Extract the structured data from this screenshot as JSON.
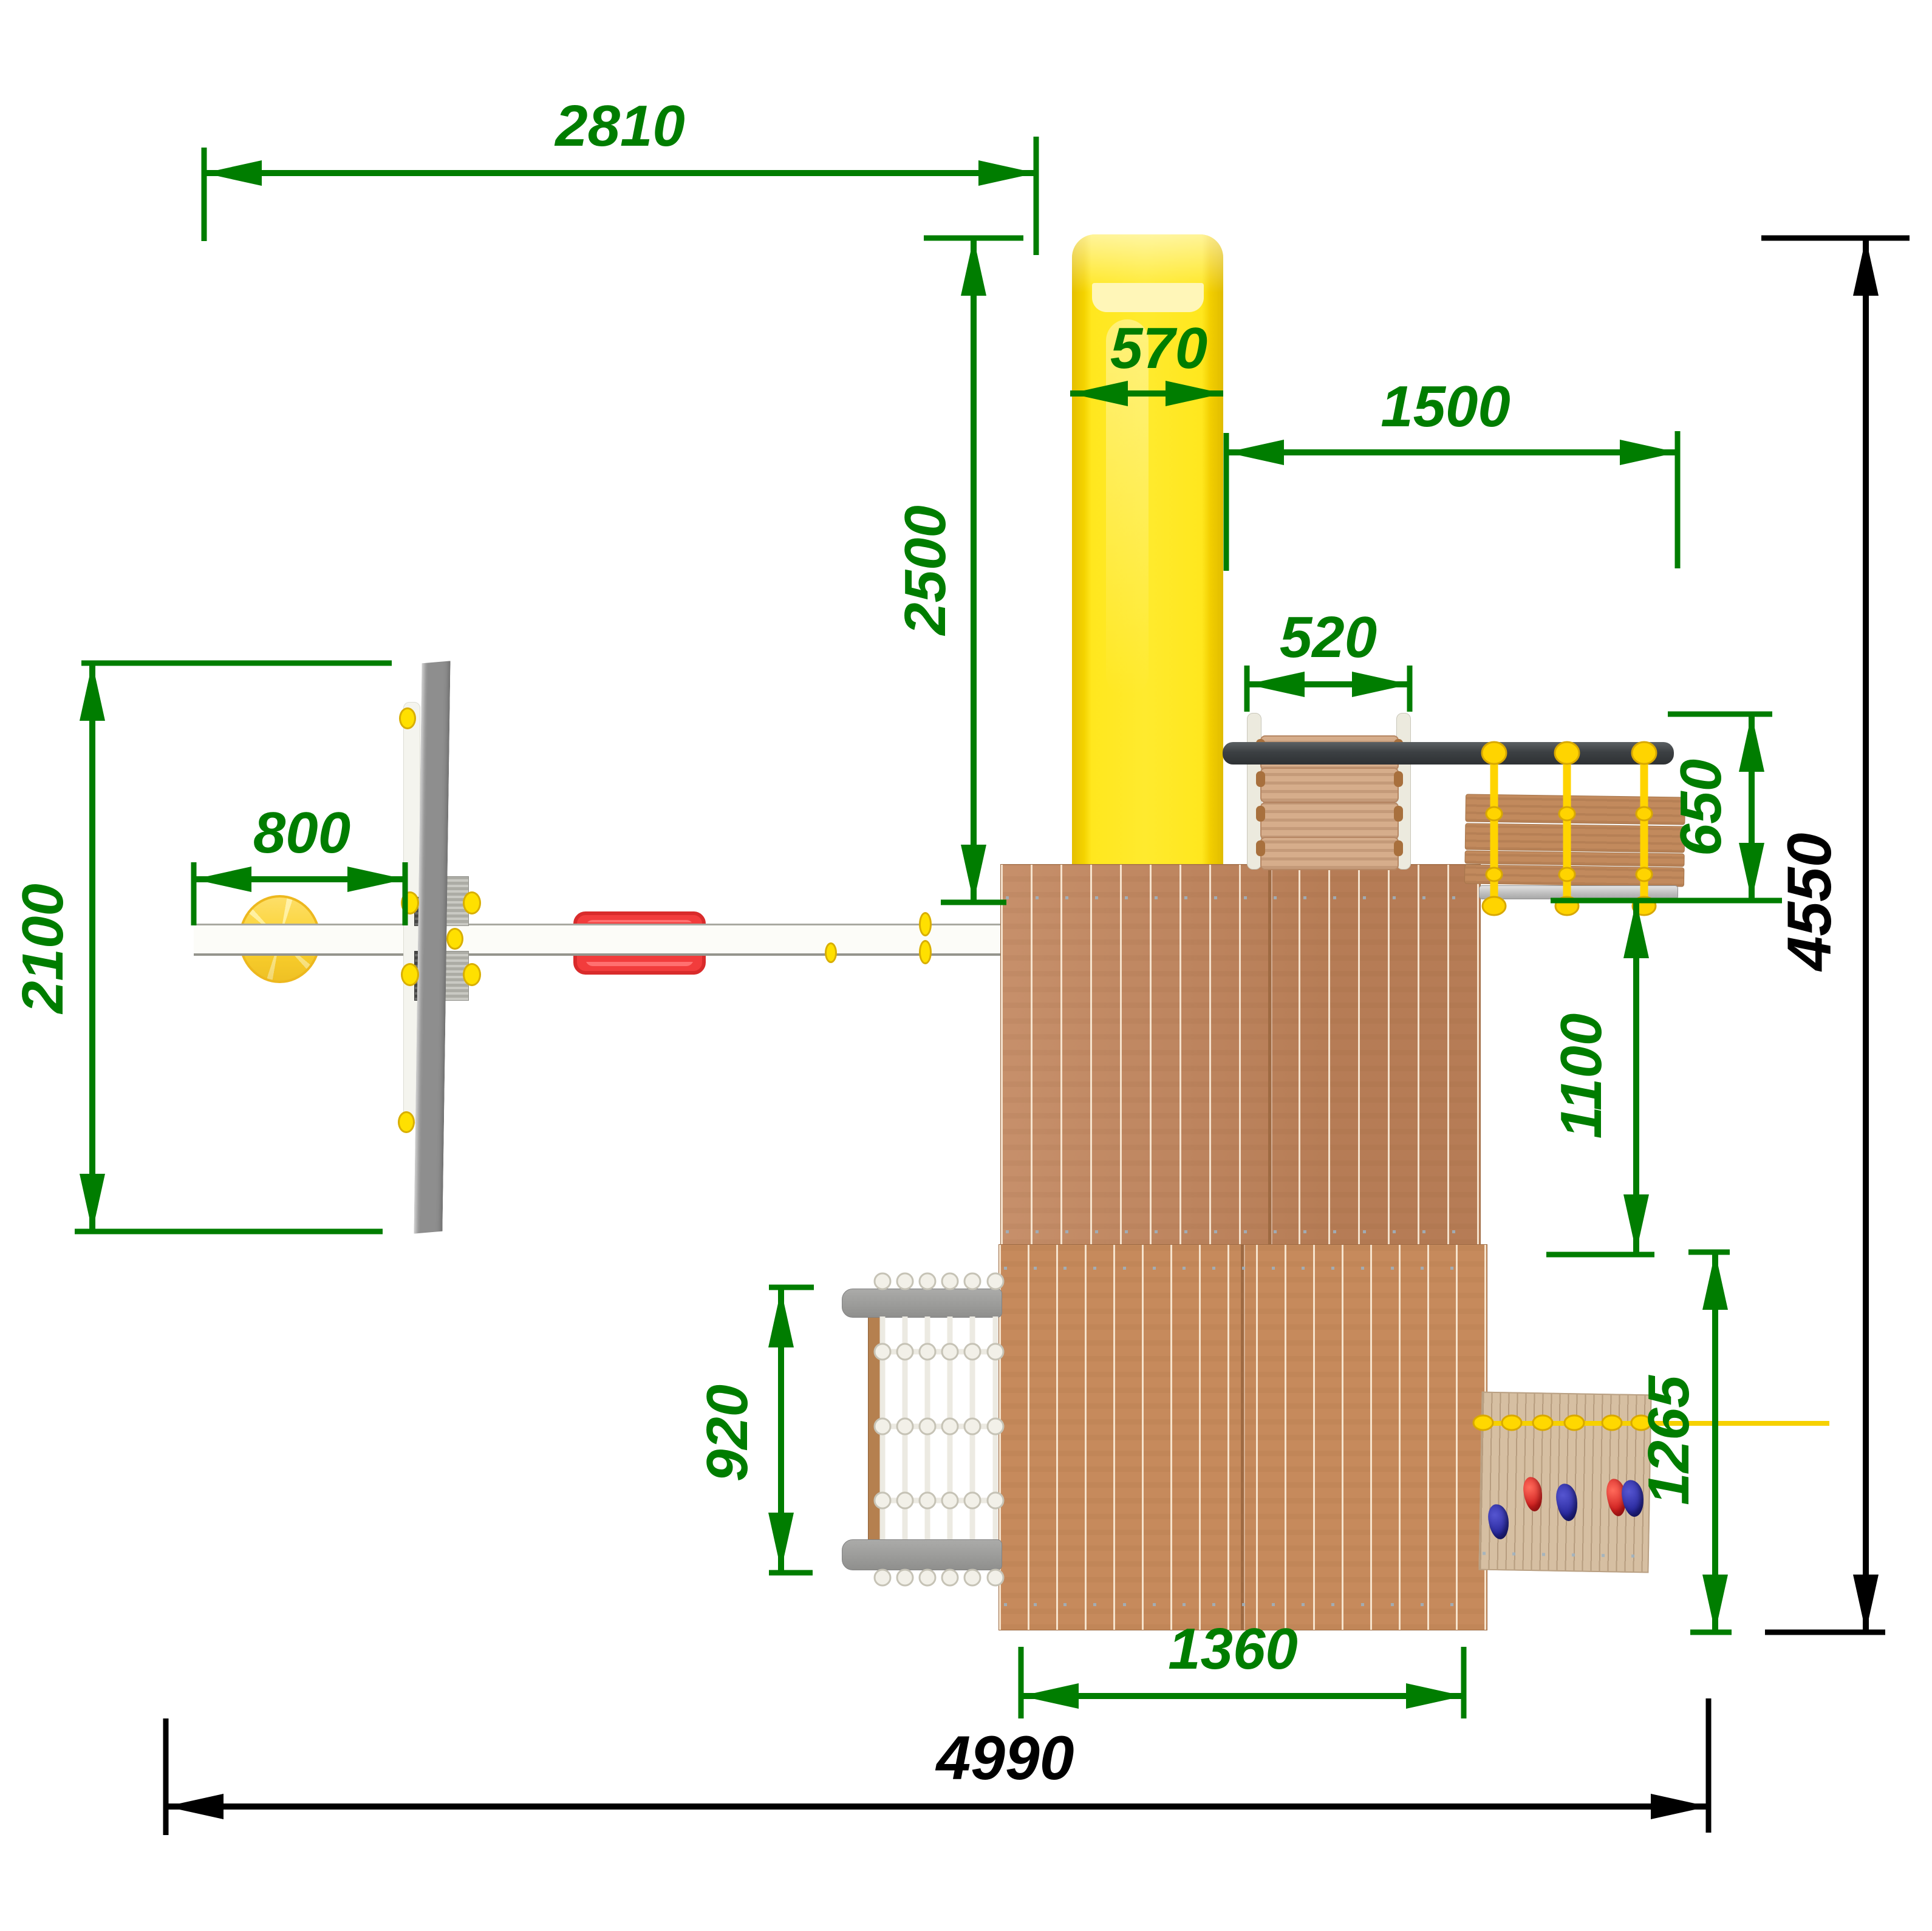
{
  "drawing": {
    "type_note": "top-view playground dimension drawing",
    "dimensions": {
      "d2810": {
        "label": "2810"
      },
      "d2500": {
        "label": "2500"
      },
      "d570": {
        "label": "570"
      },
      "d1500": {
        "label": "1500"
      },
      "d520": {
        "label": "520"
      },
      "d650": {
        "label": "650"
      },
      "d1100": {
        "label": "1100"
      },
      "d1265": {
        "label": "1265"
      },
      "d920": {
        "label": "920"
      },
      "d2100": {
        "label": "2100"
      },
      "d800": {
        "label": "800"
      },
      "d1360": {
        "label": "1360"
      },
      "d4990": {
        "label": "4990"
      },
      "d4550": {
        "label": "4550"
      }
    },
    "colors": {
      "dimension_green": "#007d00",
      "dimension_black": "#000000",
      "slide_yellow": "#ffe71e",
      "wood_deck": "#c0835a",
      "wood_light": "#d6bfa2",
      "seat_red": "#f23c3c",
      "rope_yellow": "#ffd400",
      "net_white": "#eceae2",
      "metal_gray": "#8e8e8e",
      "hold_blue": "#26269a",
      "hold_red": "#cf1f1f"
    }
  }
}
